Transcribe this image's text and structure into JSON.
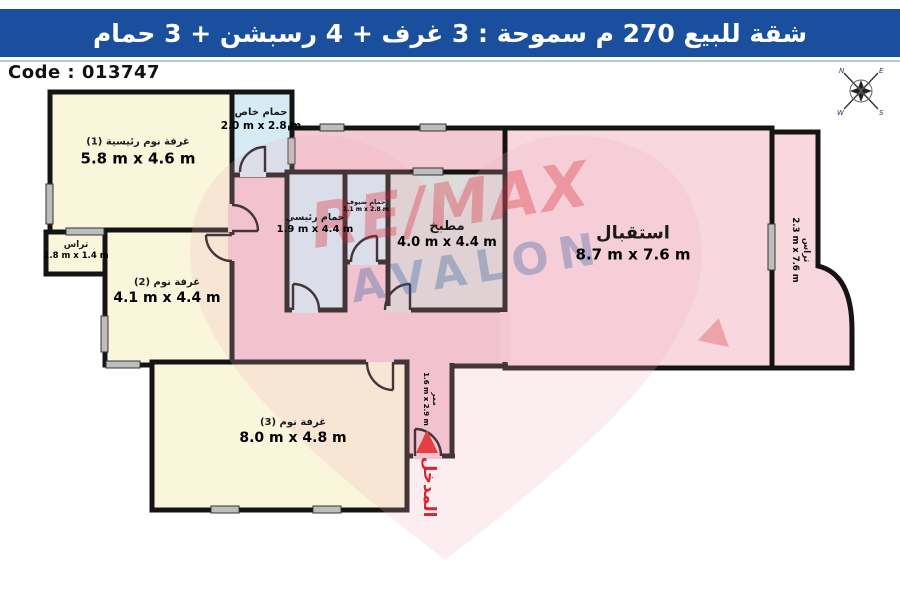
{
  "header": {
    "title": "شقة للبيع 270 م سموحة :  3 غرف + 4 رسبشن + 3 حمام",
    "bg_color": "#1A4F9E"
  },
  "code_label": "Code : 013747",
  "compass": {
    "n": "N",
    "e": "E",
    "s": "S",
    "w": "W"
  },
  "watermark": {
    "line1": "RE/MAX",
    "line2": "AVALON",
    "red": "#D8242F",
    "blue": "#2C5AA0"
  },
  "rooms": {
    "master_bedroom": {
      "name": "غرفة نوم رئيسية (1)",
      "size": "5.8 m x 4.6 m"
    },
    "private_bath": {
      "name": "حمام خاص",
      "size": "2.0 m x 2.8 m"
    },
    "terrace_left": {
      "name": "تراس",
      "size": "1.8 m x 1.4 m"
    },
    "bedroom_2": {
      "name": "غرفة نوم (2)",
      "size": "4.1 m x 4.4 m"
    },
    "bedroom_3": {
      "name": "غرفة نوم (3)",
      "size": "8.0 m x 4.8 m"
    },
    "main_bath": {
      "name": "حمام رئيسي",
      "size": "1.9 m x 4.4 m"
    },
    "guest_bath": {
      "name": "حمام ضيوف",
      "size": "1.1 m x 2.8 m"
    },
    "kitchen": {
      "name": "مطبخ",
      "size": "4.0 m x 4.4 m"
    },
    "reception": {
      "name": "استقبال",
      "size": "8.7 m x 7.6 m"
    },
    "terrace_right": {
      "name": "تراس",
      "size": "2.3 m x 7.6 m"
    },
    "corridor": {
      "name": "ممر",
      "size": "1.6 m x 2.9 m"
    },
    "entrance": {
      "name": "المدخل"
    }
  },
  "colors": {
    "bedroom_fill": "#FAF6DC",
    "bath_fill": "#D5ECF5",
    "kitchen_fill": "#DBDBDB",
    "reception_fill": "#F8D8DE",
    "hall_fill": "#F3C9D4",
    "wall": "#141414",
    "window": "#BDBDBD",
    "entrance_red": "#E02020"
  }
}
